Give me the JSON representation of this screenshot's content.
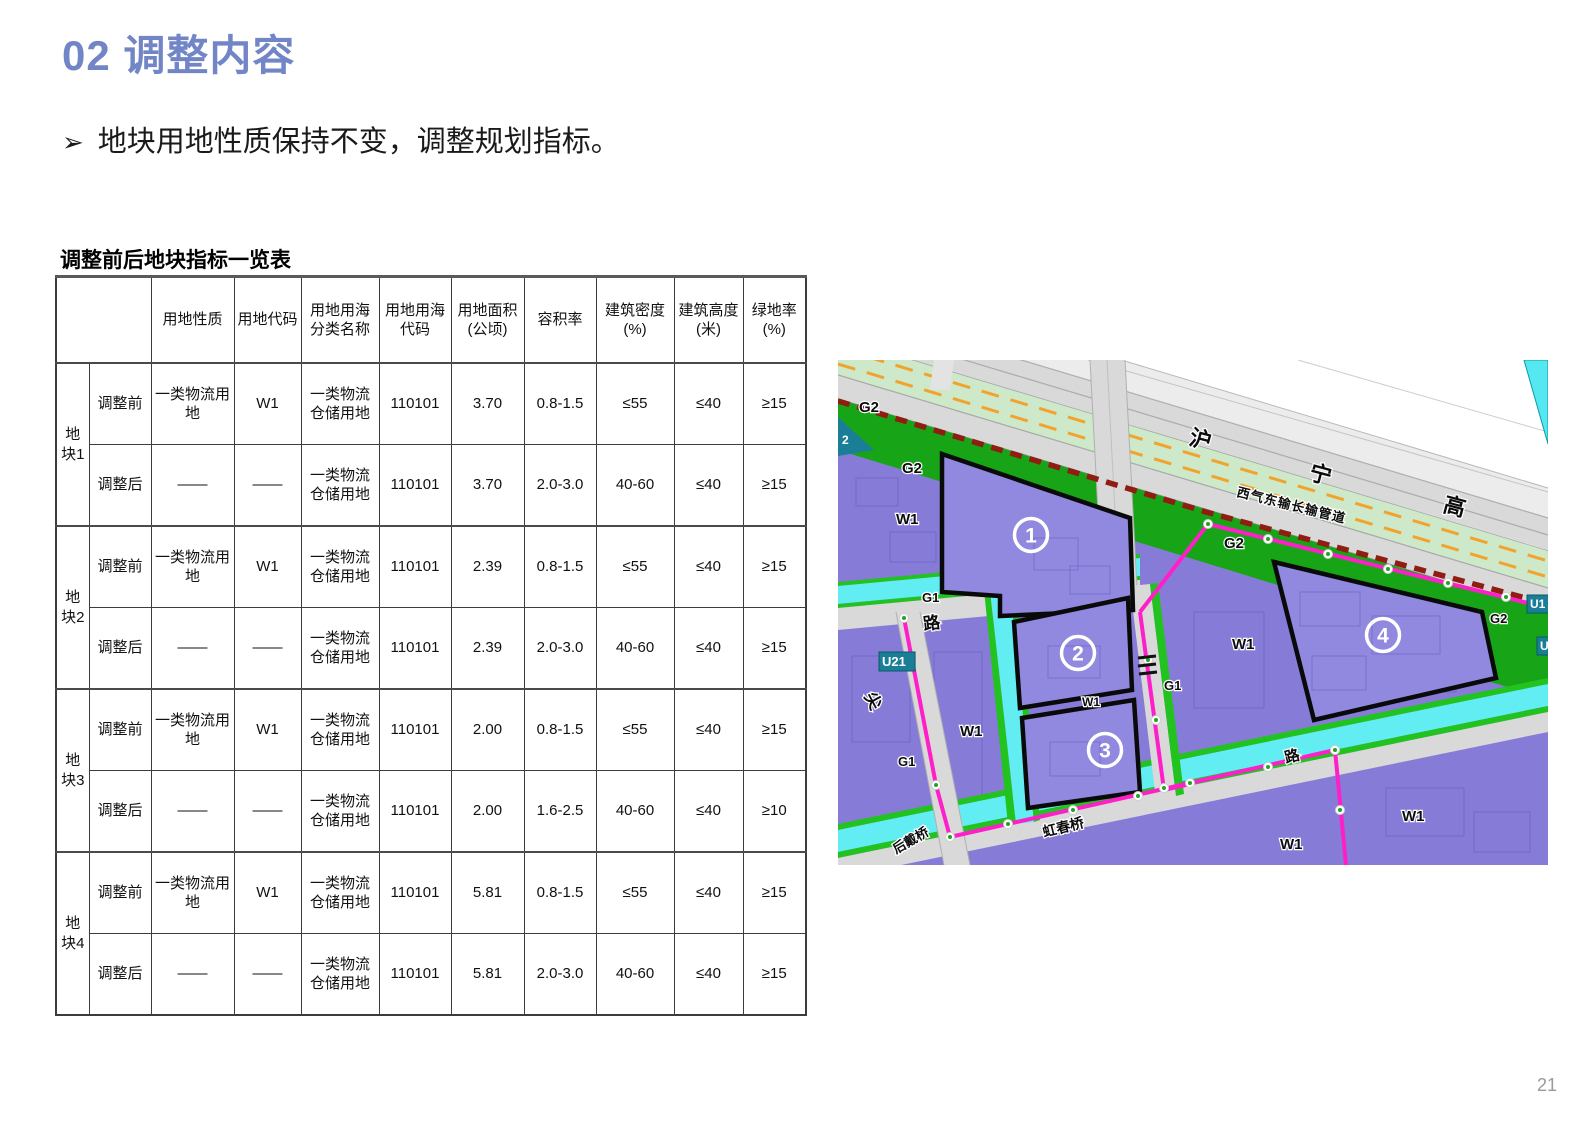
{
  "page": {
    "number": "21"
  },
  "header": {
    "title": "02 调整内容",
    "accent_color": "#7286C7"
  },
  "bullet": {
    "marker": "➢",
    "text": "地块用地性质保持不变，调整规划指标。"
  },
  "table": {
    "title": "调整前后地块指标一览表",
    "col_headers": [
      "用地性质",
      "用地代码",
      "用地用海分类名称",
      "用地用海代码",
      "用地面积 (公顷)",
      "容积率",
      "建筑密度 (%)",
      "建筑高度 (米)",
      "绿地率 (%)"
    ],
    "groups": [
      {
        "label": "地块1",
        "rows": [
          [
            "调整前",
            "一类物流用地",
            "W1",
            "一类物流仓储用地",
            "110101",
            "3.70",
            "0.8-1.5",
            "≤55",
            "≤40",
            "≥15"
          ],
          [
            "调整后",
            "——",
            "——",
            "一类物流仓储用地",
            "110101",
            "3.70",
            "2.0-3.0",
            "40-60",
            "≤40",
            "≥15"
          ]
        ]
      },
      {
        "label": "地块2",
        "rows": [
          [
            "调整前",
            "一类物流用地",
            "W1",
            "一类物流仓储用地",
            "110101",
            "2.39",
            "0.8-1.5",
            "≤55",
            "≤40",
            "≥15"
          ],
          [
            "调整后",
            "——",
            "——",
            "一类物流仓储用地",
            "110101",
            "2.39",
            "2.0-3.0",
            "40-60",
            "≤40",
            "≥15"
          ]
        ]
      },
      {
        "label": "地块3",
        "rows": [
          [
            "调整前",
            "一类物流用地",
            "W1",
            "一类物流仓储用地",
            "110101",
            "2.00",
            "0.8-1.5",
            "≤55",
            "≤40",
            "≥15"
          ],
          [
            "调整后",
            "——",
            "——",
            "一类物流仓储用地",
            "110101",
            "2.00",
            "1.6-2.5",
            "40-60",
            "≤40",
            "≥10"
          ]
        ]
      },
      {
        "label": "地块4",
        "rows": [
          [
            "调整前",
            "一类物流用地",
            "W1",
            "一类物流仓储用地",
            "110101",
            "5.81",
            "0.8-1.5",
            "≤55",
            "≤40",
            "≥15"
          ],
          [
            "调整后",
            "——",
            "——",
            "一类物流仓储用地",
            "110101",
            "5.81",
            "2.0-3.0",
            "40-60",
            "≤40",
            "≥15"
          ]
        ]
      }
    ]
  },
  "map": {
    "colors": {
      "plot_purple": "#9089DF",
      "field_purple": "#867CD8",
      "green_g2": "#17A517",
      "pale_green": "#CDE9C9",
      "canal_cyan": "#62EDF2",
      "boundary_magenta": "#FF1FC9",
      "pipeline_red": "#8F1D12",
      "orange_dash": "#F2A32E",
      "road_gray": "#D9D9D9",
      "utility_teal": "#1A7F96"
    },
    "markers": [
      {
        "n": "1",
        "x": 193,
        "y": 175
      },
      {
        "n": "2",
        "x": 240,
        "y": 293
      },
      {
        "n": "3",
        "x": 267,
        "y": 390
      },
      {
        "n": "4",
        "x": 545,
        "y": 275
      }
    ],
    "labels": [
      {
        "text": "G2",
        "x": 21,
        "y": 52,
        "size": 15
      },
      {
        "text": "2",
        "x": 4,
        "y": 84,
        "size": 12,
        "badgetext": true
      },
      {
        "text": "G2",
        "x": 64,
        "y": 113,
        "size": 15
      },
      {
        "text": "W1",
        "x": 58,
        "y": 164,
        "size": 15
      },
      {
        "text": "G1",
        "x": 84,
        "y": 242,
        "size": 13
      },
      {
        "text": "路",
        "x": 86,
        "y": 270,
        "size": 17,
        "rot": -8
      },
      {
        "text": "U21",
        "x": 44,
        "y": 306,
        "size": 13,
        "badge": true
      },
      {
        "text": "尖",
        "x": 26,
        "y": 336,
        "size": 17,
        "rot": 62
      },
      {
        "text": "G1",
        "x": 60,
        "y": 406,
        "size": 13
      },
      {
        "text": "W1",
        "x": 122,
        "y": 376,
        "size": 15
      },
      {
        "text": "后戴桥",
        "x": 58,
        "y": 494,
        "size": 13,
        "rot": -30
      },
      {
        "text": "虹春桥",
        "x": 206,
        "y": 477,
        "size": 14,
        "rot": -14
      },
      {
        "text": "W1",
        "x": 244,
        "y": 346,
        "size": 12
      },
      {
        "text": "G1",
        "x": 326,
        "y": 330,
        "size": 13
      },
      {
        "text": "W1",
        "x": 394,
        "y": 289,
        "size": 15
      },
      {
        "text": "G2",
        "x": 386,
        "y": 188,
        "size": 15
      },
      {
        "text": "G2",
        "x": 652,
        "y": 263,
        "size": 13
      },
      {
        "text": "U1",
        "x": 692,
        "y": 248,
        "size": 12,
        "badge": true
      },
      {
        "text": "U1",
        "x": 702,
        "y": 290,
        "size": 12,
        "badge": true
      },
      {
        "text": "W1",
        "x": 564,
        "y": 461,
        "size": 15
      },
      {
        "text": "W1",
        "x": 442,
        "y": 489,
        "size": 15
      },
      {
        "text": "路",
        "x": 448,
        "y": 403,
        "size": 15,
        "rot": -14
      },
      {
        "text": "沪",
        "x": 350,
        "y": 84,
        "size": 22,
        "rot": 15
      },
      {
        "text": "宁",
        "x": 470,
        "y": 119,
        "size": 22,
        "rot": 15
      },
      {
        "text": "高",
        "x": 604,
        "y": 151,
        "size": 22,
        "rot": 15
      },
      {
        "text": "西气东输长输管道",
        "x": 398,
        "y": 136,
        "size": 13,
        "rot": 14,
        "spacing": 1
      }
    ]
  }
}
